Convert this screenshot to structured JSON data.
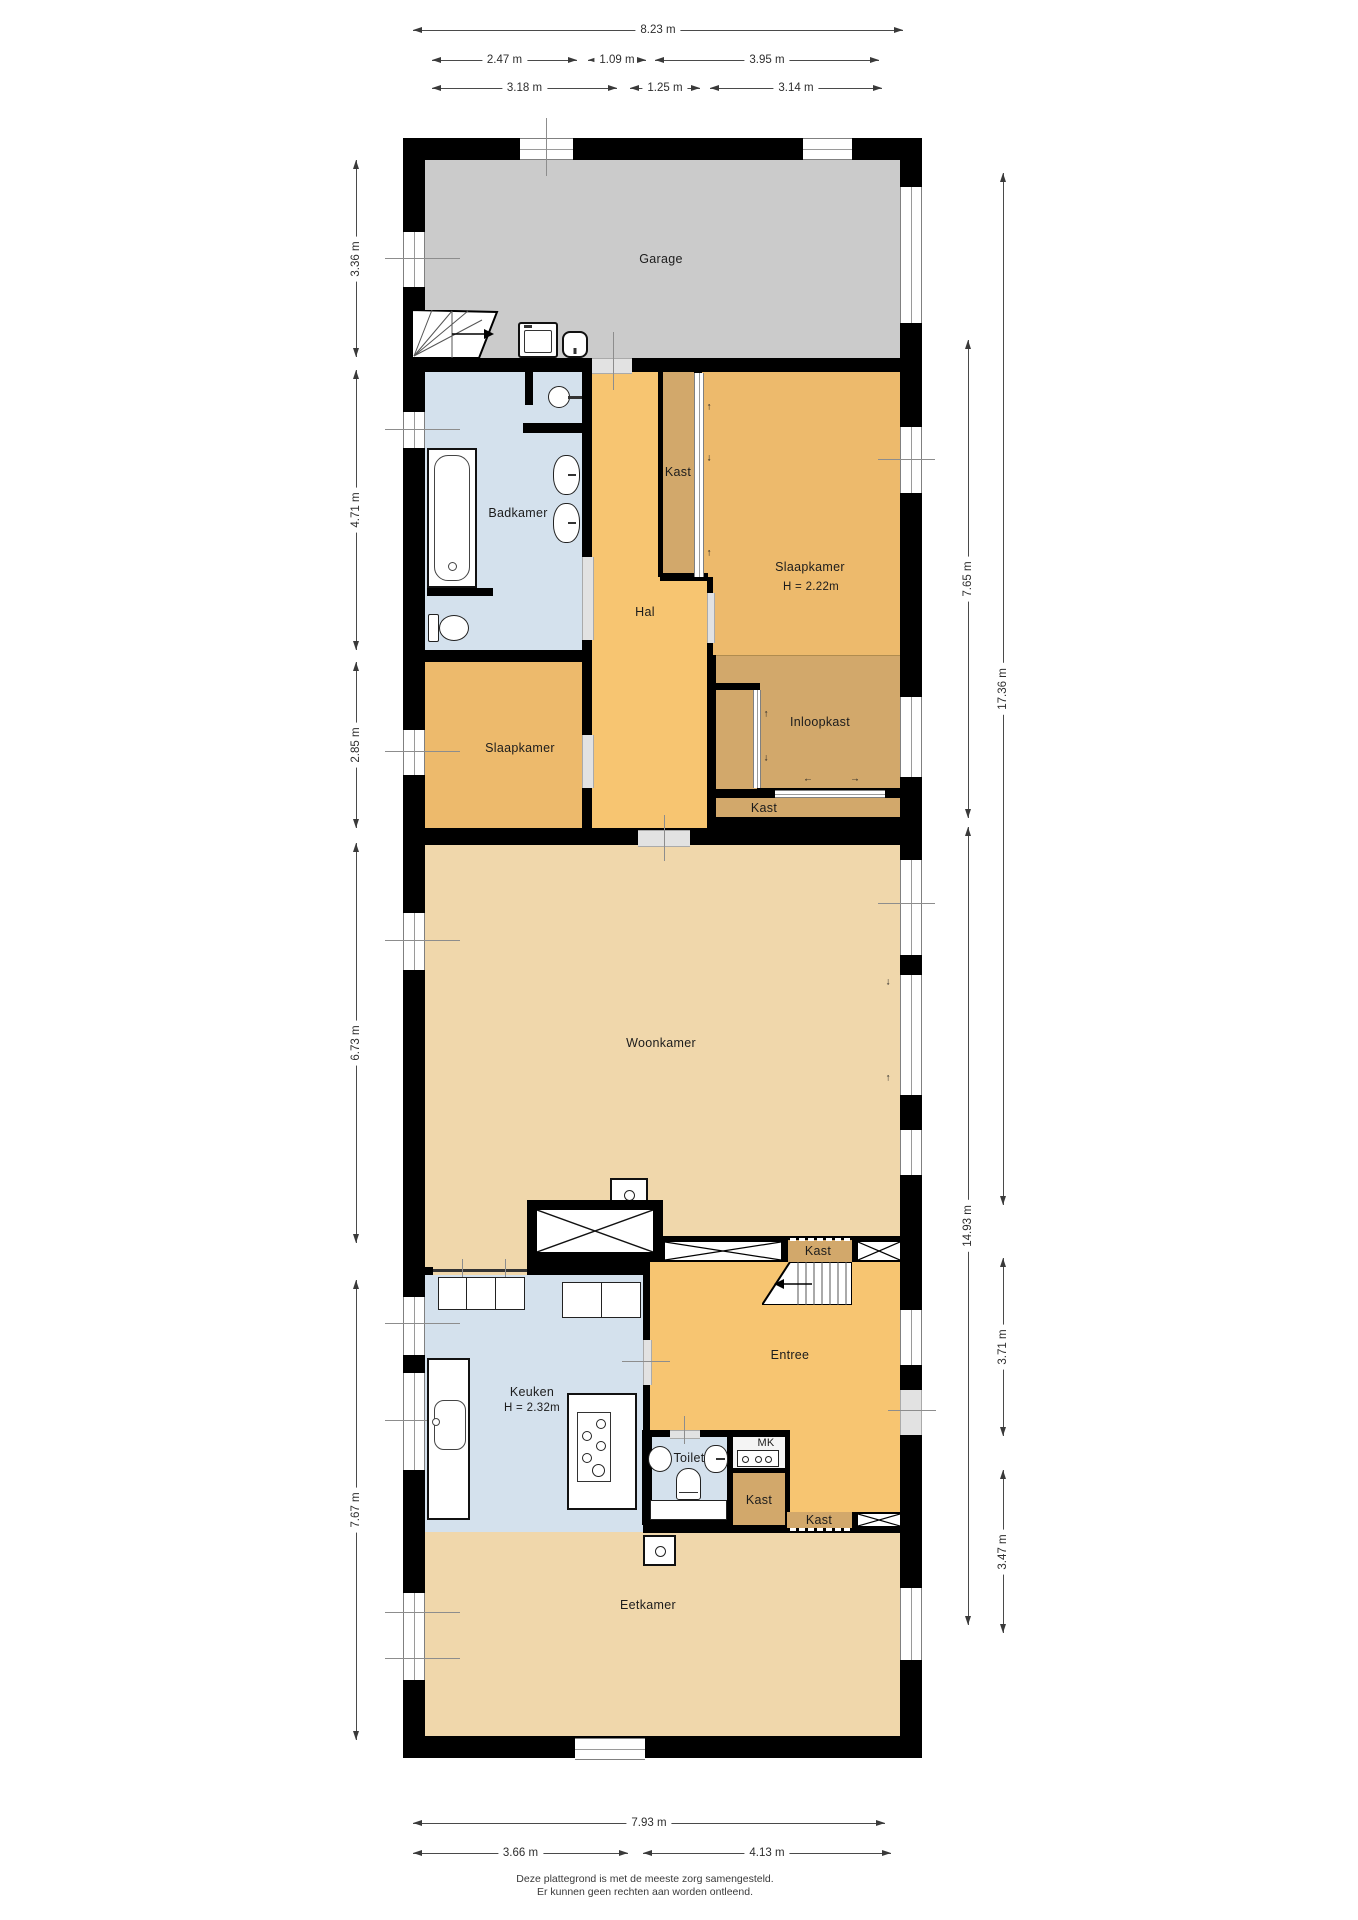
{
  "rooms": {
    "garage": {
      "label": "Garage"
    },
    "badkamer": {
      "label": "Badkamer"
    },
    "hal": {
      "label": "Hal"
    },
    "kast_hal": {
      "label": "Kast"
    },
    "slaapkamer_rechts": {
      "label": "Slaapkamer",
      "height": "H = 2.22m"
    },
    "slaapkamer_links": {
      "label": "Slaapkamer"
    },
    "inloopkast": {
      "label": "Inloopkast"
    },
    "kast_inloopkast": {
      "label": "Kast"
    },
    "woonkamer": {
      "label": "Woonkamer"
    },
    "keuken": {
      "label": "Keuken",
      "height": "H = 2.32m"
    },
    "entree": {
      "label": "Entree"
    },
    "kast_entree": {
      "label": "Kast"
    },
    "toilet": {
      "label": "Toilet"
    },
    "mk": {
      "label": "MK"
    },
    "kast_gang": {
      "label": "Kast"
    },
    "kast_eetkamer": {
      "label": "Kast"
    },
    "eetkamer": {
      "label": "Eetkamer"
    }
  },
  "dimensions": {
    "top": {
      "total": "8.23 m",
      "row2": [
        "2.47 m",
        "1.09 m",
        "3.95 m"
      ],
      "row3": [
        "3.18 m",
        "1.25 m",
        "3.14 m"
      ]
    },
    "bottom": {
      "total": "7.93 m",
      "row2": [
        "3.66 m",
        "4.13 m"
      ]
    },
    "left": [
      "3.36 m",
      "4.71 m",
      "2.85 m",
      "6.73 m",
      "7.67 m"
    ],
    "right_inner": [
      "7.65 m",
      "14.93 m"
    ],
    "right_outer": [
      "17.36 m",
      "3.71 m",
      "3.47 m"
    ]
  },
  "icons": {
    "arrow_up": "↑",
    "arrow_down": "↓",
    "arrow_left": "←",
    "arrow_right": "→"
  },
  "footer": {
    "line1": "Deze plattegrond is met de meeste zorg samengesteld.",
    "line2": "Er kunnen geen rechten aan worden ontleend."
  },
  "colors": {
    "wall": "#000000",
    "garage": "#cbcbcb",
    "wet_room": "#d4e1ed",
    "hall": "#f7c571",
    "bedroom": "#edba6c",
    "closet": "#d2a86b",
    "living": "#f0d7ab",
    "dimension_text": "#2e2e2e"
  }
}
